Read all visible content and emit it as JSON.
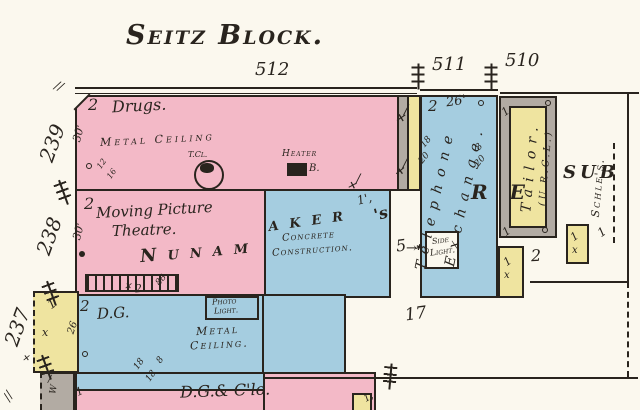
{
  "colors": {
    "paper": "#fbf8ee",
    "pink": "#f3b9c7",
    "blue": "#a5cde0",
    "yellow": "#efe4a0",
    "gray": "#b2aba3",
    "ink": "#29241e"
  },
  "icons": {
    "window_x": "✕",
    "slash": "∕",
    "double_slash": "∕∕",
    "arrow": "→",
    "asterisk": "✱"
  },
  "title": "Seitz Block.",
  "streets": {
    "front": [
      "512",
      "511",
      "510"
    ],
    "side": [
      "239",
      "238",
      "237"
    ]
  },
  "drugs_store": {
    "stories": "2",
    "name": "Drugs.",
    "ceiling": "Metal Ceiling",
    "depth": "30'",
    "chimney_label": "T.Cl.",
    "heater_label": "Heater",
    "heater_suffix": "B.",
    "num_a": "12",
    "num_b": "16"
  },
  "theatre": {
    "stories": "2",
    "depth": "30'",
    "name_line1": "Moving Picture",
    "name_line2": "Theatre.",
    "porch_num_a": "2.",
    "porch_num_b": "88"
  },
  "nunamaker": {
    "name_part1": "Nunam",
    "name_part2": "aker",
    "name_suffix": "'s",
    "story_mark": "1',",
    "construction_line1": "Concrete",
    "construction_line2": "Construction."
  },
  "telephone_exchange": {
    "stories": "2",
    "width": "26'",
    "name_line1": "Telephone",
    "name_line2": "Exchange.",
    "num_left_a": "18",
    "num_left_b": "20",
    "num_right_a": "8",
    "num_right_b": "20",
    "five": "5",
    "side_light_line1": "Side",
    "side_light_line2": "Light."
  },
  "tailor": {
    "name": "Tailor.",
    "note": "(U.R.C.L.)",
    "mark_top": "1",
    "mark_bottom": "1"
  },
  "resub": {
    "part1": "RE",
    "part2": "SUB"
  },
  "schles": {
    "name": "Schle's.",
    "mark": "1"
  },
  "lot_number": "17",
  "dry_goods": {
    "stories": "2",
    "name": "D.G.",
    "ceiling_line1": "Metal",
    "ceiling_line2": "Ceiling.",
    "photo_line1": "Photo",
    "photo_line2": "Light.",
    "depth": "26",
    "num_a": "18",
    "num_b": "18",
    "num_c": "8"
  },
  "dg_clothing": {
    "mark": "1",
    "name": "D.G.& C'lo.",
    "corner_mark": "1,"
  },
  "rear_510": {
    "two": "2",
    "outbuilding_mark": "1",
    "outbuilding_x": "x"
  },
  "b237": {
    "mark": "1",
    "x": "x",
    "w": "W"
  }
}
